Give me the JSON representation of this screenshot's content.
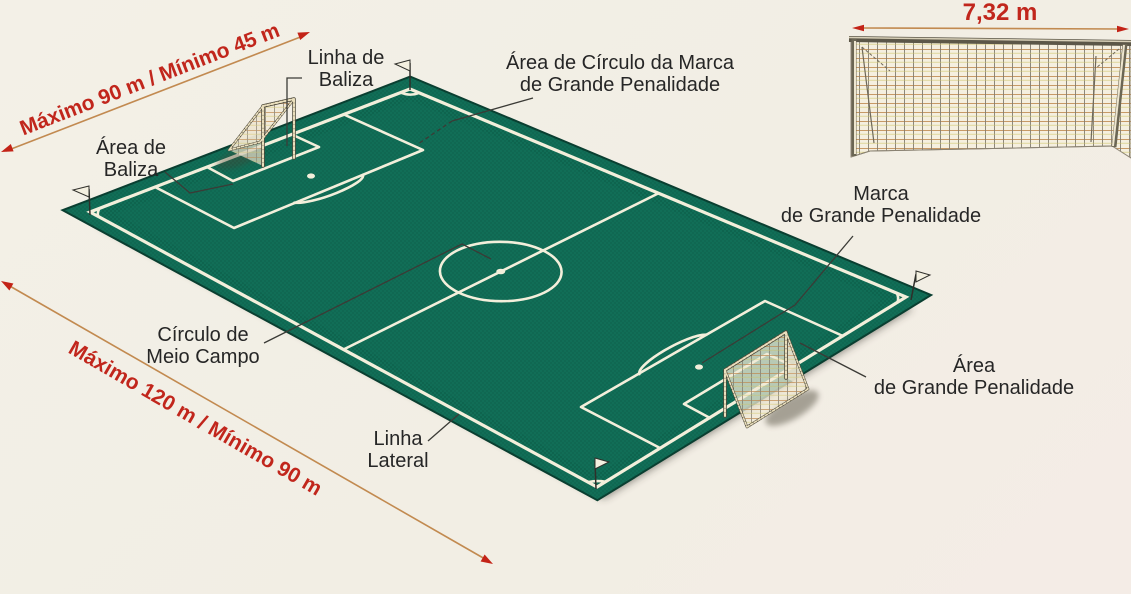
{
  "labels": {
    "goal_line": {
      "line1": "Linha de",
      "line2": "Baliza"
    },
    "penalty_arc": {
      "line1": "Área de Círculo da Marca",
      "line2": "de Grande Penalidade"
    },
    "goal_area": {
      "line1": "Área de",
      "line2": "Baliza"
    },
    "center_circle": {
      "line1": "Círculo de",
      "line2": "Meio Campo"
    },
    "touchline": {
      "line1": "Linha",
      "line2": "Lateral"
    },
    "penalty_mark": {
      "line1": "Marca",
      "line2": "de Grande Penalidade"
    },
    "penalty_area": {
      "line1": "Área",
      "line2": "de Grande Penalidade"
    }
  },
  "dimensions": {
    "field_width": "Máximo 90 m / Mínimo 45 m",
    "field_length": "Máximo 120 m / Mínimo 90 m",
    "goal_width": "7,32 m"
  },
  "colors": {
    "field_green": "#116e57",
    "field_edge": "#0a3f31",
    "line_white": "#f3efdb",
    "dimension_text_red": "#c1261c",
    "dimension_line_tan": "#c28a50",
    "arrowhead_red": "#c32317",
    "label_text": "#262626",
    "background": "#f2efe6"
  }
}
